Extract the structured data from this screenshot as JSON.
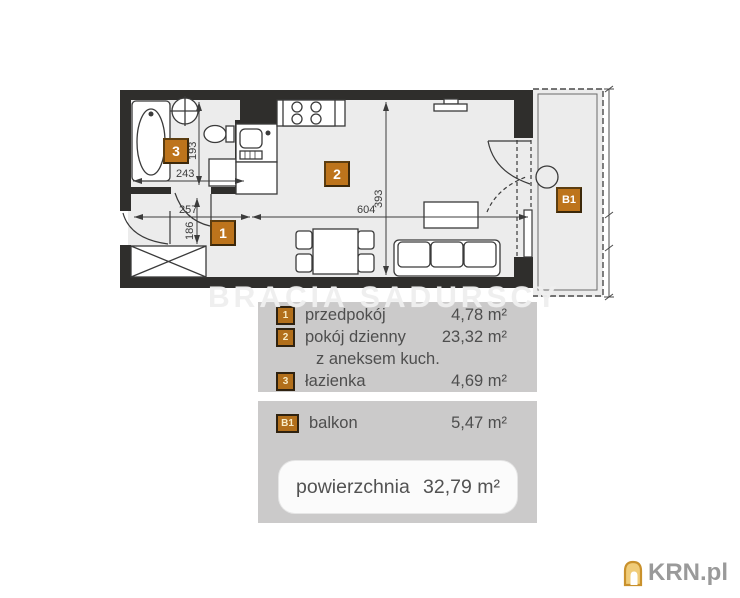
{
  "plan": {
    "labels": {
      "hall": "1",
      "living": "2",
      "bath": "3",
      "balcony": "B1"
    },
    "dimensions": {
      "bath_width": "243",
      "bath_depth": "193",
      "hall_width": "257",
      "hall_depth": "186",
      "living_width": "604",
      "living_depth": "393"
    }
  },
  "legend": {
    "rooms": [
      {
        "marker": "1",
        "name": "przedpokój",
        "area": "4,78 m²"
      },
      {
        "marker": "2",
        "name": "pokój dzienny",
        "name_line2": "z aneksem kuch.",
        "area": "23,32 m²"
      },
      {
        "marker": "3",
        "name": "łazienka",
        "area": "4,69 m²"
      }
    ],
    "balcony": {
      "marker": "B1",
      "name": "balkon",
      "area": "5,47 m²"
    },
    "total": {
      "label": "powierzchnia",
      "value": "32,79 m²"
    }
  },
  "watermark": {
    "text": "BRACIA SADURSCY"
  },
  "branding": {
    "logo_text": "KRN.pl"
  },
  "colors": {
    "label_orange": "#bd741c",
    "wall_dark": "#2f2e2c",
    "floor_gray": "#ececec",
    "panel_gray": "#cbcaca",
    "legend_text": "#4e4e4e",
    "logo_gray": "#9a9a9a"
  }
}
